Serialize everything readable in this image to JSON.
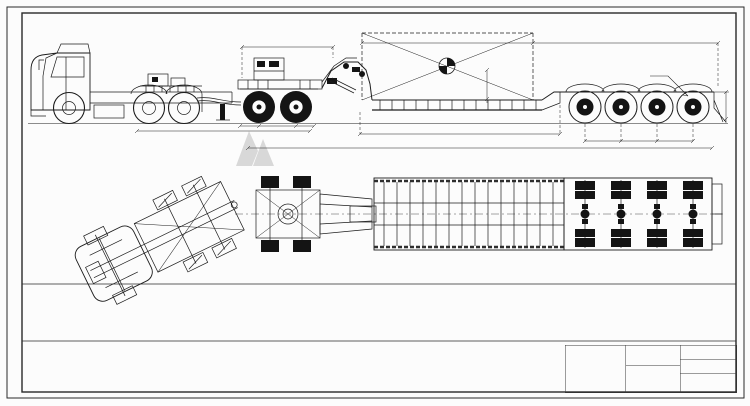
{
  "watermark": {
    "text": "titanvehicle.com",
    "logo": "mountain-logo",
    "color": "#c4c4c4"
  },
  "side_view": {
    "dims": {
      "gooseneck": "4246",
      "cargo_top": "8600",
      "load": "130000kg",
      "cg_note": "重心(距地1.5m位置)",
      "deck_height": "1500",
      "rear_note": "后悬挂升降行程±70mm",
      "axle_spacing": "1310",
      "rear_height": "900",
      "platform": "13600(有效载货平台)",
      "overall": "17900",
      "tractor_gap": "5885",
      "dolly_spacing": "1350"
    }
  },
  "tables": {
    "left": {
      "title_row": [
        {
          "t": "分体鹅颈式平板半挂车技术性能参数",
          "cs": 10,
          "cl": "tt"
        }
      ],
      "rows": [
        [
          {
            "t": "外形尺寸",
            "rs": 3,
            "cl": "lb"
          },
          {
            "t": "长",
            "cl": "lb"
          },
          "(mm)",
          "17900",
          {
            "t": "轮胎数量",
            "cl": "lb"
          },
          "16",
          {
            "t": "轮胎型号",
            "cl": "lb"
          },
          "12.00R20",
          {
            "t": "选装号",
            "cl": "lb"
          },
          "12Kw柴油发电机组"
        ],
        [
          {
            "t": "宽",
            "cl": "lb"
          },
          "(mm)",
          "2500+250×2(活动翼板)",
          {
            "t": "钢圈",
            "cl": "lb"
          },
          {
            "t": "8.5-20",
            "cs": 3
          },
          "",
          ""
        ],
        [
          {
            "t": "高",
            "cl": "lb"
          },
          "(mm)",
          "2200(承载面离地600)",
          {
            "t": "主梁材质",
            "cl": "lb"
          },
          {
            "t": "HG60",
            "cs": 3
          },
          {
            "t": "车轴",
            "cl": "lb"
          },
          "20t轴 3根"
        ],
        [
          {
            "t": "鹅颈牵引销高度",
            "cs": 2,
            "cl": "lb"
          },
          "(mm)",
          "1400",
          {
            "t": "底板",
            "cl": "lb"
          },
          {
            "t": "花纹板 4mm",
            "cs": 3
          },
          {
            "t": "电源系统",
            "cl": "lb"
          },
          "24V LED车灯"
        ],
        [
          {
            "t": "承载平面高度",
            "cs": 2,
            "cl": "lb"
          },
          "(mm)",
          "600",
          {
            "t": "悬挂",
            "cl": "lb"
          },
          {
            "t": "钢板弹簧悬挂",
            "cs": 3
          },
          {
            "t": "备胎",
            "cl": "lb"
          },
          "2只"
        ],
        [
          {
            "t": "牵引销",
            "cs": 2,
            "cl": "lb"
          },
          "",
          "90#",
          {
            "t": "整备质量",
            "cl": "lb"
          },
          "(kg)",
          {
            "t": "18500(含鹅颈,以实际配置为准)",
            "cs": 4
          }
        ],
        [
          {
            "t": "轴距",
            "cs": 2,
            "cl": "lb"
          },
          "(mm)",
          "12595+1310+1310+1310",
          {
            "t": "最大载货质量",
            "cl": "lb"
          },
          "(kg)",
          {
            "t": "120000",
            "cs": 4
          }
        ],
        [
          {
            "t": "轮距",
            "cs": 2,
            "cl": "lb"
          },
          "(mm)",
          "1840",
          {
            "t": "最大总质量",
            "cl": "lb"
          },
          "(kg)",
          {
            "t": "138500",
            "cs": 4
          }
        ]
      ]
    },
    "right": {
      "title_row": [
        {
          "t": "两桥挂车技术性能参数",
          "cs": 8,
          "cl": "tt"
        }
      ],
      "rows": [
        [
          {
            "t": "外形尺寸",
            "rs": 3,
            "cl": "lb"
          },
          {
            "t": "长",
            "cl": "lb"
          },
          "(mm)",
          "6300",
          {
            "t": "轮胎数量",
            "cl": "lb"
          },
          "8",
          {
            "t": "轮胎型号",
            "cl": "lb"
          },
          "12.00R20"
        ],
        [
          {
            "t": "宽",
            "cl": "lb"
          },
          "(mm)",
          "2500",
          {
            "t": "钢圈",
            "cl": "lb"
          },
          {
            "t": "8.5-20",
            "cs": 3
          }
        ],
        [
          {
            "t": "高",
            "cl": "lb"
          },
          "(mm)",
          "1500",
          {
            "t": "主梁材质",
            "cl": "lb"
          },
          {
            "t": "HG60",
            "cs": 3
          }
        ],
        [
          {
            "t": "牵引销离地高度",
            "cs": 2,
            "cl": "lb"
          },
          "(mm)",
          "1330",
          {
            "t": "车轴",
            "cl": "lb"
          },
          {
            "t": "16t轴 2根",
            "cs": 3
          }
        ],
        [
          {
            "t": "承载平面高度",
            "cs": 2,
            "cl": "lb"
          },
          "(mm)",
          "1450",
          {
            "t": "悬挂",
            "cl": "lb"
          },
          {
            "t": "钢板弹簧悬挂",
            "cs": 3
          }
        ],
        [
          {
            "t": "牵引销",
            "cs": 2,
            "cl": "lb"
          },
          "",
          "90#",
          {
            "t": "整备质量",
            "cl": "lb"
          },
          "(kg)",
          {
            "t": "4500(以实际配置为准)",
            "cs": 2
          }
        ],
        [
          {
            "t": "轴距",
            "cs": 2,
            "cl": "lb"
          },
          "(mm)",
          "3855+1310",
          {
            "t": "最大载货质量",
            "cl": "lb"
          },
          "(kg)",
          {
            "t": "50000",
            "cs": 2
          }
        ],
        [
          {
            "t": "轮距",
            "cs": 2,
            "cl": "lb"
          },
          "(mm)",
          "1840",
          {
            "t": "最大总质量",
            "cl": "lb"
          },
          "(kg)",
          {
            "t": "54500",
            "cs": 2
          }
        ]
      ]
    }
  },
  "title_block": {
    "type": "方案确认图",
    "company": "山东泰坦车辆有限公司",
    "drawing_title": "两桥挂+120T鹅颈分体4轴线平板车",
    "date": "2020-06-05",
    "grid_rows": [
      [
        "",
        "",
        "",
        "",
        "",
        ""
      ],
      [
        "",
        "",
        "",
        "",
        "",
        ""
      ],
      [
        "",
        "",
        "",
        "",
        "",
        ""
      ],
      [
        "标记",
        "处数",
        "分区",
        "更改文件号",
        "签字",
        "日期"
      ],
      [
        "设计",
        "",
        "",
        "校对",
        "",
        ""
      ],
      [
        "审核",
        "",
        "",
        "工艺",
        "",
        ""
      ],
      [
        "批准",
        "",
        "",
        "标准化",
        "",
        ""
      ]
    ],
    "scale_rows": [
      [
        "阶段标记",
        "",
        "重量",
        "比例"
      ],
      [
        "",
        "",
        "",
        "1:50"
      ]
    ]
  },
  "side_strip": {
    "rows": [
      [
        "制图"
      ],
      [
        "■  ■"
      ],
      [
        "描校"
      ],
      [
        "■  ■"
      ],
      [
        "旧底图总号"
      ],
      [
        "■  ■"
      ],
      [
        "底图总号"
      ],
      [
        "■  ■"
      ],
      [
        "日 期"
      ],
      [
        "■  ■"
      ],
      [
        "签 字"
      ],
      [
        "■  ■"
      ]
    ]
  }
}
